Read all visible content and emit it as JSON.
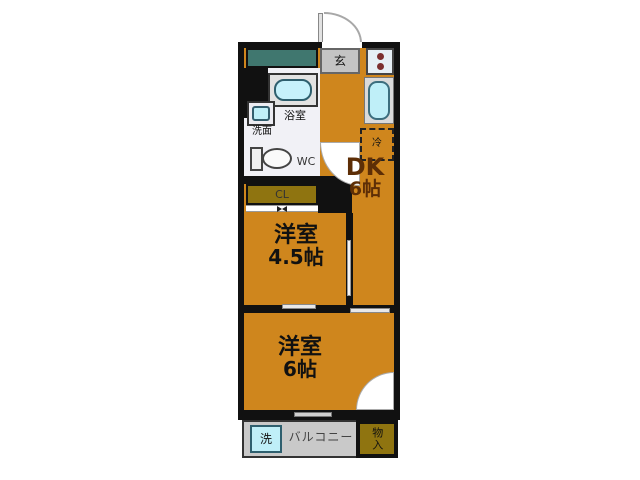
{
  "floorplan": {
    "type": "apartment-floor-plan",
    "colors": {
      "floor_orange": "#CF861D",
      "wall_black": "#111111",
      "closet_olive": "#8F7410",
      "cabinet_teal": "#40776F",
      "fixture_cyan": "#BFEFF8",
      "balcony_gray": "#C9C9C9",
      "entrance_gray": "#C4C4C4",
      "dk_text_brown": "#5D2E06",
      "stove_dot_red": "#7C2F2F"
    },
    "labels": {
      "entrance": "玄",
      "bath": "浴室",
      "washbasin": "洗面",
      "wc": "WC",
      "closet": "CL",
      "fridge": "冷",
      "dk": "DK",
      "dk_size": "6帖",
      "room_a": "洋室",
      "room_a_size": "4.5帖",
      "room_b": "洋室",
      "room_b_size": "6帖",
      "balcony": "バルコニー",
      "washer": "洗",
      "storage": "物入"
    }
  }
}
